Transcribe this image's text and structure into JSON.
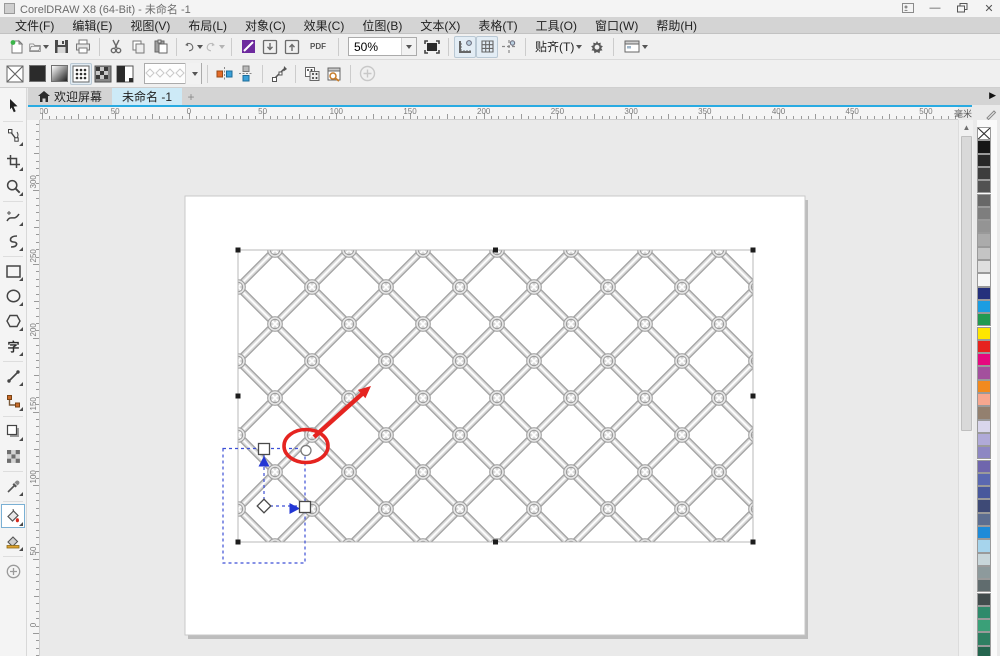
{
  "window": {
    "title": "CorelDRAW X8 (64-Bit) - 未命名 -1",
    "controls": [
      "sign-in",
      "minimize",
      "restore",
      "close"
    ]
  },
  "menubar": {
    "items": [
      "文件(F)",
      "编辑(E)",
      "视图(V)",
      "布局(L)",
      "对象(C)",
      "效果(C)",
      "位图(B)",
      "文本(X)",
      "表格(T)",
      "工具(O)",
      "窗口(W)",
      "帮助(H)"
    ]
  },
  "standard_toolbar": {
    "zoom_level": "50%",
    "pdf_label": "PDF",
    "snap_label": "贴齐(T)",
    "icons": [
      "new-document",
      "open",
      "save",
      "print",
      "cut",
      "copy",
      "paste",
      "undo",
      "redo",
      "application-launcher",
      "import",
      "export",
      "publish-pdf",
      "zoom-level",
      "fullscreen-preview",
      "show-rulers",
      "show-grid",
      "show-guidelines",
      "snap-to",
      "options-gear",
      "interface-chooser"
    ]
  },
  "property_bar": {
    "icons": [
      "no-fill",
      "uniform-fill",
      "fountain-fill",
      "vector-pattern-fill",
      "bitmap-pattern-fill",
      "two-color-pattern-fill",
      "fill-picker",
      "mirror-tiles-horizontal",
      "mirror-tiles-vertical",
      "transform-fill",
      "copy-fill",
      "edit-fill",
      "add-preset"
    ],
    "active_fill_mode": "vector-pattern-fill"
  },
  "tabbar": {
    "welcome_label": "欢迎屏幕",
    "document_label": "未命名 -1",
    "new_tab_label": "+"
  },
  "rulers": {
    "horizontal_labels": [
      "100",
      "50",
      "0",
      "50",
      "100",
      "150",
      "200",
      "250",
      "300",
      "350",
      "400",
      "450",
      "500"
    ],
    "vertical_labels": [
      "300",
      "250",
      "200",
      "150",
      "100",
      "50",
      "0"
    ],
    "units_label": "毫米"
  },
  "toolbox": {
    "items": [
      {
        "name": "pick-tool",
        "active": false,
        "flyout": false
      },
      {
        "name": "shape-tool",
        "active": false,
        "flyout": true
      },
      {
        "name": "crop-tool",
        "active": false,
        "flyout": true
      },
      {
        "name": "zoom-tool",
        "active": false,
        "flyout": true
      },
      {
        "name": "freehand-tool",
        "active": false,
        "flyout": true
      },
      {
        "name": "curve-tool",
        "active": false,
        "flyout": true
      },
      {
        "name": "rectangle-tool",
        "active": false,
        "flyout": true
      },
      {
        "name": "ellipse-tool",
        "active": false,
        "flyout": true
      },
      {
        "name": "polygon-tool",
        "active": false,
        "flyout": true
      },
      {
        "name": "text-tool",
        "active": false,
        "flyout": true
      },
      {
        "name": "two-point-line-tool",
        "active": false,
        "flyout": true
      },
      {
        "name": "connector-tool",
        "active": false,
        "flyout": true
      },
      {
        "name": "drop-shadow-tool",
        "active": false,
        "flyout": true
      },
      {
        "name": "transparency-tool",
        "active": false,
        "flyout": false
      },
      {
        "name": "color-eyedropper-tool",
        "active": false,
        "flyout": true
      },
      {
        "name": "interactive-fill-tool",
        "active": true,
        "flyout": true
      },
      {
        "name": "smart-fill-tool",
        "active": false,
        "flyout": true
      },
      {
        "name": "more-tools",
        "active": false,
        "flyout": false
      }
    ]
  },
  "palette": {
    "colors": [
      "none",
      "#161616",
      "#282828",
      "#3d3d3d",
      "#525252",
      "#686868",
      "#7e7e7e",
      "#949494",
      "#ababab",
      "#c4c4c4",
      "#dfdfdf",
      "#f7f7f7",
      "#24307c",
      "#1b9de2",
      "#229a51",
      "#ffe600",
      "#e6231e",
      "#e5097f",
      "#a3509d",
      "#f28a1e",
      "#f7a78f",
      "#93806f",
      "#d9d6ec",
      "#b0aad8",
      "#8d87c3",
      "#6f66ad",
      "#5a68b1",
      "#48589c",
      "#3e4a76",
      "#5d6e90",
      "#1e8bd8",
      "#a6d4ec",
      "#c8d6da",
      "#8d9a9c",
      "#606c6e",
      "#424c4d",
      "#2f8a6b",
      "#3aa078",
      "#2e7f62",
      "#24654e"
    ]
  },
  "canvas": {
    "selection_handle_color": "#1d1d1d",
    "fill_overlay_color": "#3d4fd6",
    "annotation_color": "#e52420",
    "accent_line_color": "#29abe2",
    "object": "chain-link-fence-image"
  }
}
